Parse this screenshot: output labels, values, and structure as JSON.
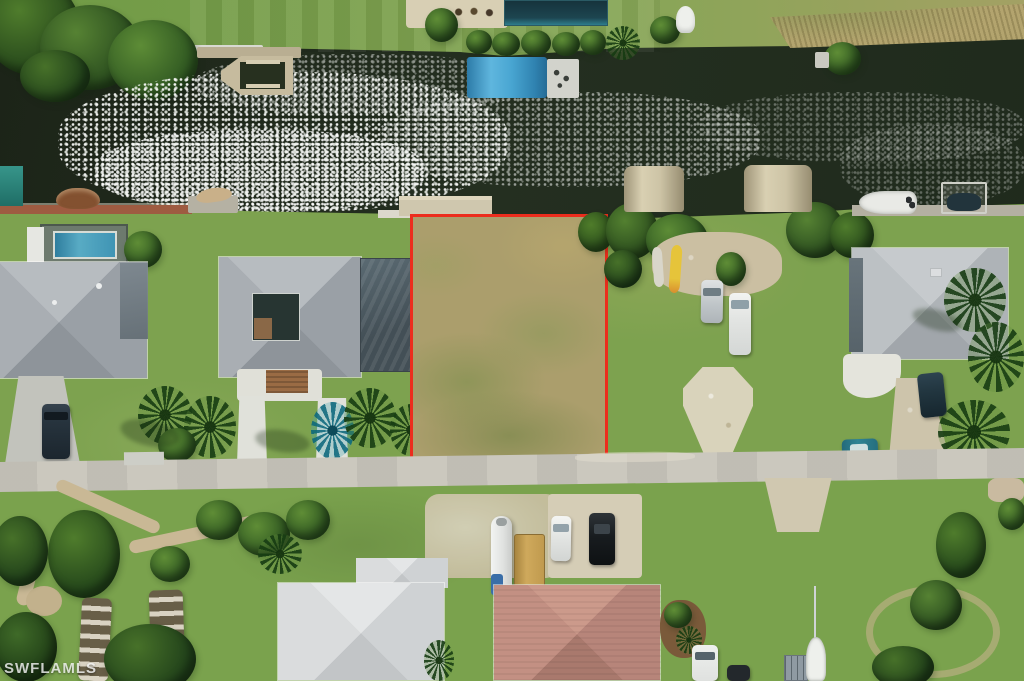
{
  "image": {
    "description": "Aerial drone photograph of a waterfront vacant residential lot outlined in red, between houses on a canal street",
    "width_px": 1024,
    "height_px": 681
  },
  "watermark": {
    "text": "SWFLAMLS"
  },
  "palette": {
    "grass": "#7da24f",
    "grassDry": "#ab9e6c",
    "water": "#212b1d",
    "road": "#c8c5bb",
    "concrete": "#d6d2c4",
    "roofGray": "#a8adb2",
    "roofWhite": "#d7d9da",
    "roofPink": "#bf8c7e",
    "redOutline": "#ec2d1d",
    "boathouseBlue": "#49a6d2",
    "canopyTan": "#cdc4a6",
    "tealRoof": "#2e8a80",
    "poolBlue": "#3f94b4",
    "seawallBrown": "#9e5b41",
    "shellWhite": "#d9d3bb",
    "reedTan": "#b3a46e"
  },
  "scene": {
    "objects": [
      "canal-water-with-sun-glint",
      "far-bank-lawn",
      "far-bank-trees",
      "patio-with-playground",
      "screened-pool-enclosure-far-bank",
      "wooden-dock-with-boat-lift",
      "blue-metal-boathouse",
      "teal-boathouse",
      "tan-boat-canopy-1",
      "tan-boat-canopy-2",
      "white-boat-at-dock",
      "boat-lift-frame",
      "concrete-dock-of-lot",
      "red-outlined-vacant-lot",
      "house-left-1-gray-roof",
      "house-left-2-gray-roof-courtyard",
      "pool-screen-enclosure",
      "swimming-pool",
      "dark-van-in-driveway",
      "white-double-driveway",
      "teal-colored-palm",
      "silver-car-on-lot",
      "white-van-on-lot",
      "yellow-kayak",
      "white-kayak",
      "shell-driveway-apron",
      "house-right-gray-roof",
      "gravel-driveway",
      "dark-suv-right-house",
      "teal-car-at-road",
      "street-road",
      "garden-paths-bottom-left",
      "boat-trailers-on-grass",
      "house-bottom-white-roof",
      "propane-tank-cylinder",
      "tan-awning",
      "white-car-bottom-driveway",
      "black-suv-bottom-driveway",
      "house-bottom-pink-roof",
      "white-van-bottom-edge",
      "sailboat-bottom-edge",
      "dirt-circle-path-bottom-right",
      "palm-trees",
      "watermark-text"
    ]
  }
}
